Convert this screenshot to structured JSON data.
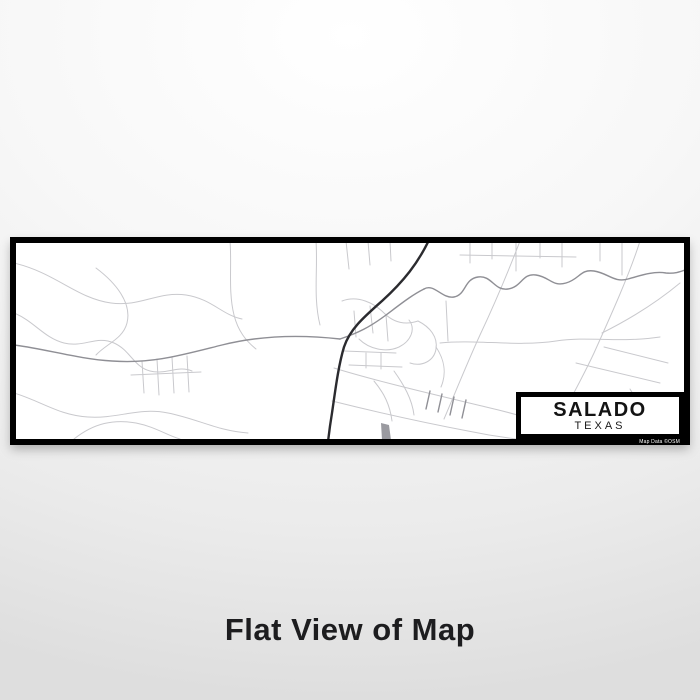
{
  "product_view": {
    "caption": "Flat View of Map"
  },
  "map_print": {
    "city": "SALADO",
    "state": "TEXAS",
    "attribution": "Map Data ©OSM",
    "colors": {
      "frame": "#000000",
      "map_bg": "#ffffff",
      "road_light": "#c9c9cd",
      "road_medium": "#8f8f95",
      "road_highway": "#2b2b2f"
    },
    "pond_points": "365,180 373,182 375,197 366,197",
    "roads": {
      "highway": [
        "M413,-3 C402,20 388,38 366,58 C348,74 334,86 328,104 C322,124 319,150 316,170 C314,182 313,190 312,199"
      ],
      "medium": [
        "M-2,102 C30,106 62,116 96,118 C136,121 166,112 206,102 C246,92 288,92 324,96",
        "M324,96 C342,90 354,84 370,72 C386,60 396,52 408,46",
        "M408,46 C418,40 426,56 438,54 C450,52 448,36 462,34 C476,32 478,48 492,46 C506,44 506,30 520,32 C534,34 536,44 550,40 C564,36 564,26 578,28 C592,30 598,40 612,36 C626,32 638,28 650,30 C660,31 666,28 672,26",
        "M414,148 L410,166 M426,151 L422,169 M438,154 L434,172 M450,157 L446,175"
      ],
      "light": [
        "M-2,20 C40,30 60,55 95,60 C125,64 142,48 170,52 C196,56 206,72 226,76",
        "M80,25 C100,40 116,60 111,80 C107,96 90,101 80,112",
        "M-2,70 C18,78 28,95 48,100 C68,105 80,92 98,100 C114,107 118,124 134,128 C150,132 162,122 176,128",
        "M-2,150 C25,158 42,172 72,174 C102,176 122,164 152,170 C182,176 202,188 232,190",
        "M58,196 C78,180 98,176 120,180 C140,184 150,192 164,196",
        "M115,132 L185,129 M126,118 L128,150 M141,116 L143,152 M156,114 L158,150 M171,113 L173,149",
        "M214,-2 C216,22 212,48 218,72 C222,88 230,98 240,106",
        "M300,-2 C302,26 297,54 304,82",
        "M330,-2 L333,26 M352,-2 L354,22 M374,-2 L375,18",
        "M454,-2 L454,20 M476,-2 L476,16 M500,-2 L500,28 M524,-2 L524,15 M546,-2 L546,24 M584,-2 L584,18 M606,-2 L606,32",
        "M444,12 L560,14",
        "M424,100 C460,96 500,104 540,98 C572,93 604,100 644,94",
        "M504,-2 C494,24 480,58 464,92 C452,118 440,148 428,176",
        "M624,-2 C614,30 596,70 578,110 C564,140 548,168 533,196",
        "M664,40 C640,60 614,76 586,90",
        "M318,125 C360,138 420,152 470,164 C500,171 524,178 546,186",
        "M316,158 C356,168 410,180 452,188 C476,193 496,196 520,198",
        "M560,120 L644,140 M588,104 L652,120",
        "M326,58 C342,52 358,60 368,70 C378,80 390,82 402,78",
        "M338,68 L340,94 M354,63 L357,90 M370,72 L372,98",
        "M343,96 C353,106 370,110 383,104 C395,98 400,86 393,77",
        "M402,78 C414,84 422,94 420,106 C418,118 406,124 394,120",
        "M328,108 L380,110 M333,122 L386,124",
        "M350,110 L350,125 M365,110 L365,126",
        "M430,58 L432,98",
        "M420,104 C428,116 431,130 425,144",
        "M378,128 C388,142 396,156 398,172",
        "M358,138 C368,150 374,162 376,178",
        "M600,150 L612,170 M614,146 L626,166 M572,166 L580,180"
      ]
    }
  }
}
